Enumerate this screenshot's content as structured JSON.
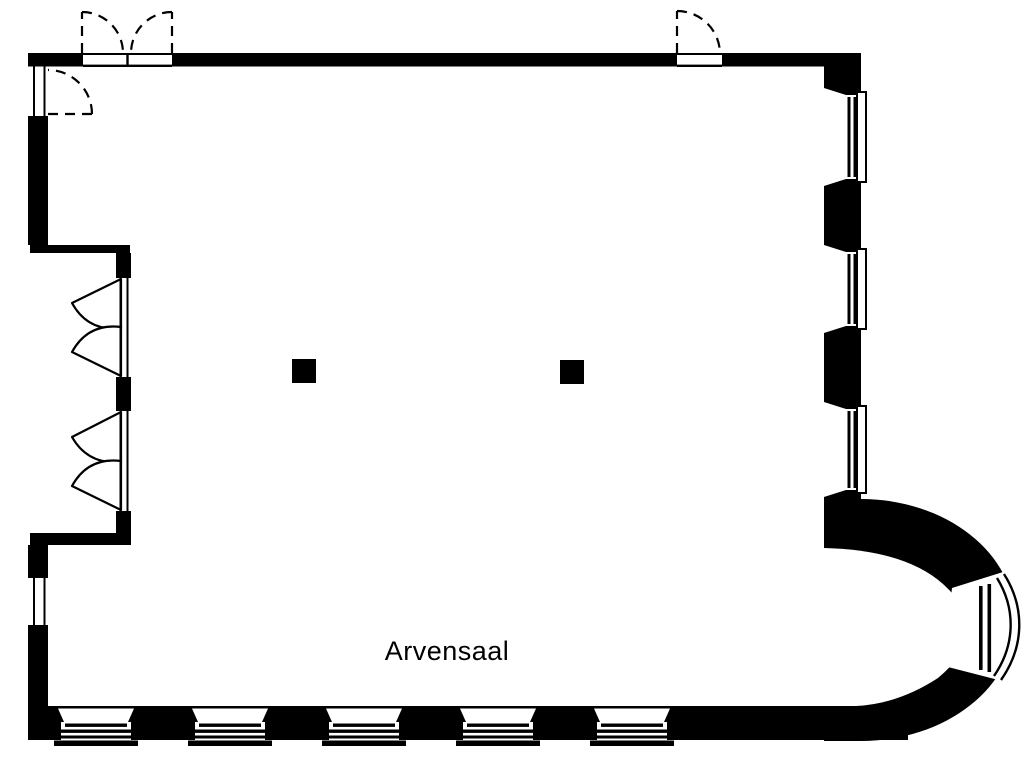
{
  "page": {
    "background": "#ffffff",
    "ink": "#000000"
  },
  "room": {
    "label": "Arvensaal"
  },
  "plan": {
    "type": "architectural floor plan",
    "columns_count": 2,
    "doors": [
      {
        "name": "double swing door",
        "location": "top wall left",
        "swing": "outward, dashed"
      },
      {
        "name": "single swing door",
        "location": "top wall right",
        "swing": "outward, dashed"
      },
      {
        "name": "single swing door",
        "location": "left wall top",
        "swing": "inward, dashed"
      }
    ],
    "windows": {
      "left_casement_leaves": 4,
      "right_wall_windows": 3,
      "bottom_wall_windows": 5,
      "left_wall_window": 1,
      "curved_bay_window_bottom_right": 1
    }
  }
}
